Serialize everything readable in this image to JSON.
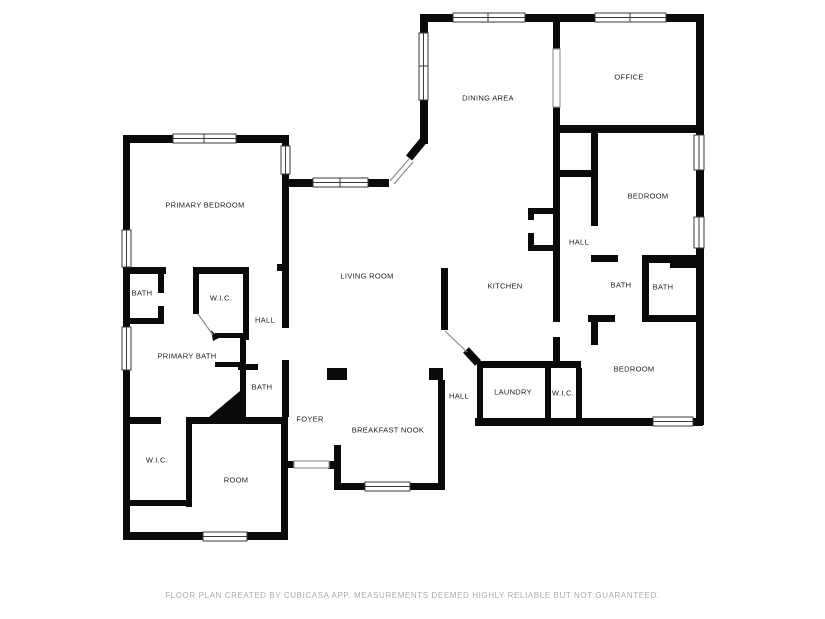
{
  "floor_plan": {
    "rooms": [
      {
        "label": "PRIMARY BEDROOM"
      },
      {
        "label": "DINING AREA"
      },
      {
        "label": "OFFICE"
      },
      {
        "label": "BEDROOM"
      },
      {
        "label": "HALL"
      },
      {
        "label": "BATH"
      },
      {
        "label": "BATH"
      },
      {
        "label": "BEDROOM"
      },
      {
        "label": "LIVING ROOM"
      },
      {
        "label": "KITCHEN"
      },
      {
        "label": "BATH"
      },
      {
        "label": "W.I.C."
      },
      {
        "label": "HALL"
      },
      {
        "label": "PRIMARY BATH"
      },
      {
        "label": "BATH"
      },
      {
        "label": "W.I.C."
      },
      {
        "label": "ROOM"
      },
      {
        "label": "FOYER"
      },
      {
        "label": "BREAKFAST NOOK"
      },
      {
        "label": "HALL"
      },
      {
        "label": "LAUNDRY"
      },
      {
        "label": "W.I.C."
      }
    ],
    "footer": "FLOOR PLAN CREATED BY CUBICASA APP. MEASUREMENTS DEEMED HIGHLY RELIABLE BUT NOT GUARANTEED.",
    "colors": {
      "background": "#ffffff",
      "wall": "#0a0a0a",
      "label": "#1c1c1c",
      "footer_text": "#ababab",
      "window_stroke": "#3a3a3a"
    }
  }
}
